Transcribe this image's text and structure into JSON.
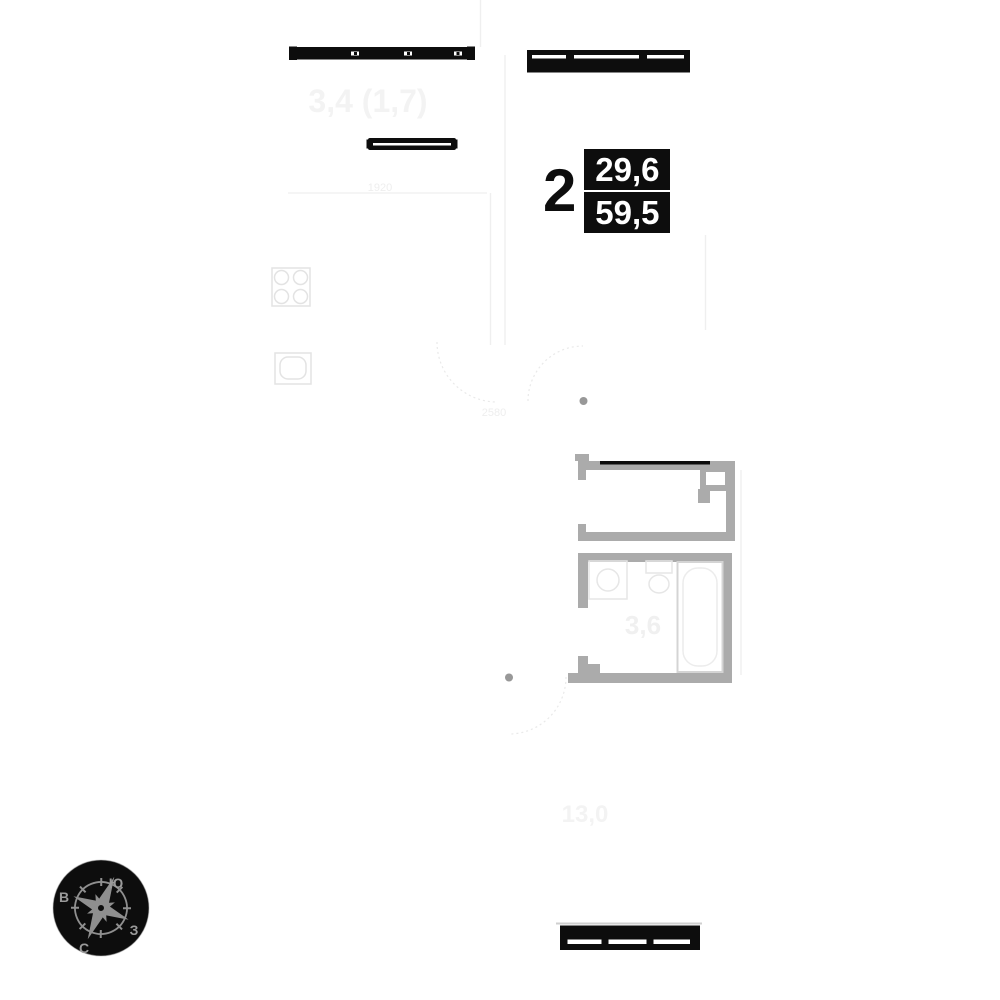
{
  "title": "apartment-floor-plan",
  "apartment": {
    "rooms_count": "2",
    "living_area": "29,6",
    "total_area": "59,5"
  },
  "room_labels": {
    "loggia_area": "3,4 (1,7)",
    "bathroom_area": "3,6",
    "living_room_area": "13,0"
  },
  "dimensions": {
    "kitchen_width": "1920",
    "hall_width": "2580"
  },
  "compass": {
    "south_label": "Ю",
    "east_label": "В",
    "west_label": "З",
    "north_label": "С"
  },
  "colors": {
    "black": "#0d0d0d",
    "wall_gray": "#ababab",
    "rose_gray": "#8f8f8f",
    "faint_gray": "#ededed"
  }
}
